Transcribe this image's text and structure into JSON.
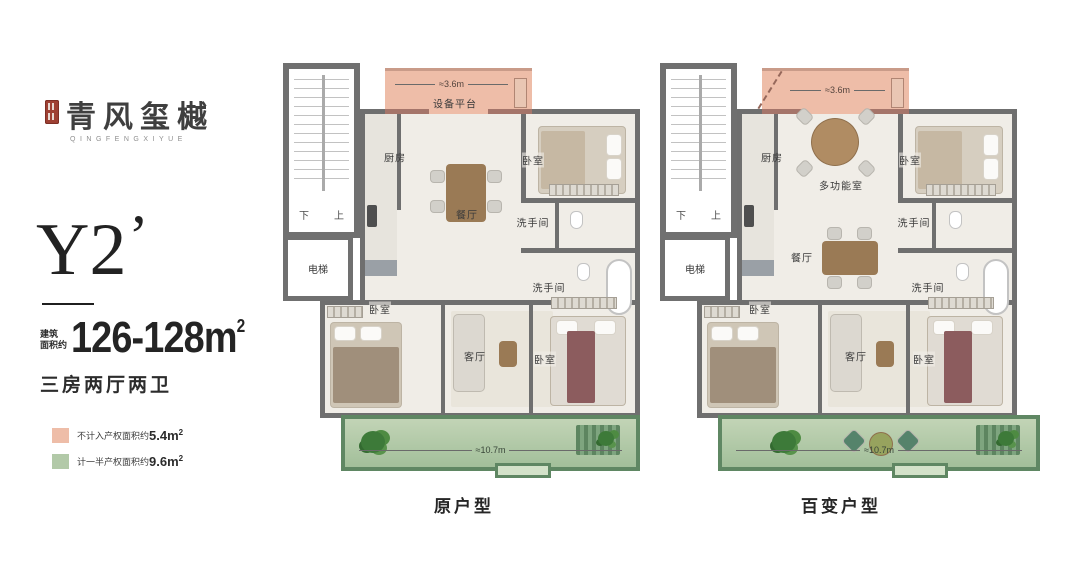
{
  "brand": {
    "name": "青风玺樾",
    "latin": "QINGFENGXIYUE"
  },
  "unit": {
    "code": "Y2",
    "prime": "’",
    "area_prefix_line1": "建筑",
    "area_prefix_line2": "面积约",
    "area_value": "126-128m",
    "area_sup": "2",
    "rooms_summary": "三房两厅两卫"
  },
  "legend": {
    "items": [
      {
        "label": "不计入产权面积约",
        "value": "5.4m",
        "sup": "2",
        "color": "#eebda8"
      },
      {
        "label": "计一半产权面积约",
        "value": "9.6m",
        "sup": "2",
        "color": "#b2c9a8"
      }
    ]
  },
  "plans": {
    "left": {
      "caption": "原户型",
      "platform_label": "设备平台",
      "platform_dim": "≈3.6m",
      "balcony_dim": "≈10.7m",
      "stair_down": "下",
      "stair_up": "上",
      "elevator": "电梯",
      "kitchen": "厨房",
      "dining": "餐厅",
      "living": "客厅",
      "bedroom_top": "卧室",
      "bedroom_left": "卧室",
      "bedroom_right": "卧室",
      "bath_top": "洗手间",
      "bath_bottom": "洗手间"
    },
    "right": {
      "caption": "百变户型",
      "platform_dim": "≈3.6m",
      "balcony_dim": "≈10.7m",
      "stair_down": "下",
      "stair_up": "上",
      "elevator": "电梯",
      "kitchen": "厨房",
      "multi_room": "多功能室",
      "dining": "餐厅",
      "living": "客厅",
      "bedroom_top": "卧室",
      "bedroom_left": "卧室",
      "bedroom_right": "卧室",
      "bath_top": "洗手间",
      "bath_bottom": "洗手间"
    }
  },
  "colors": {
    "wall": "#6f6f6f",
    "platform_fill": "#eebda8",
    "platform_wall": "#a5756a",
    "balcony_fill": "#b2c9a8",
    "balcony_wall": "#5f8763",
    "seal": "#9e4033"
  }
}
